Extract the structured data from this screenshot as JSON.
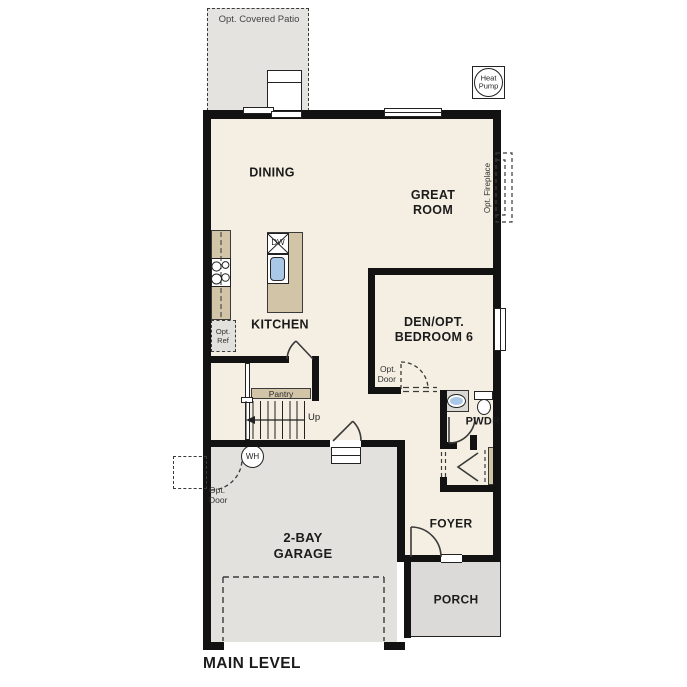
{
  "footer": {
    "label": "MAIN LEVEL"
  },
  "rooms": {
    "dining": {
      "label": "DINING"
    },
    "great_room": {
      "line1": "GREAT",
      "line2": "ROOM"
    },
    "kitchen": {
      "label": "KITCHEN"
    },
    "den": {
      "line1": "DEN/OPT.",
      "line2": "BEDROOM 6"
    },
    "powder": {
      "label": "PWDR"
    },
    "foyer": {
      "label": "FOYER"
    },
    "garage": {
      "line1": "2-BAY",
      "line2": "GARAGE"
    },
    "porch": {
      "label": "PORCH"
    }
  },
  "annotations": {
    "patio": "Opt. Covered Patio",
    "heat_pump": {
      "line1": "Heat",
      "line2": "Pump"
    },
    "fireplace": "Opt. Fireplace",
    "opt_ref": {
      "line1": "Opt.",
      "line2": "Ref"
    },
    "pantry": "Pantry",
    "up": "Up",
    "water_heater": "WH",
    "dishwasher": "DW",
    "opt_door_garage": {
      "line1": "Opt.",
      "line2": "Door"
    },
    "opt_door_bedroom": {
      "line1": "Opt.",
      "line2": "Door"
    }
  },
  "colors": {
    "interior": "#f4efe2",
    "patio": "#e4e3e0",
    "garage": "#e2e1de",
    "porch": "#dbdad8",
    "counter": "#d2c5a7",
    "sink": "#a9c7e7",
    "wall": "#121212",
    "line": "#222222",
    "text": "#1b1b1b"
  }
}
